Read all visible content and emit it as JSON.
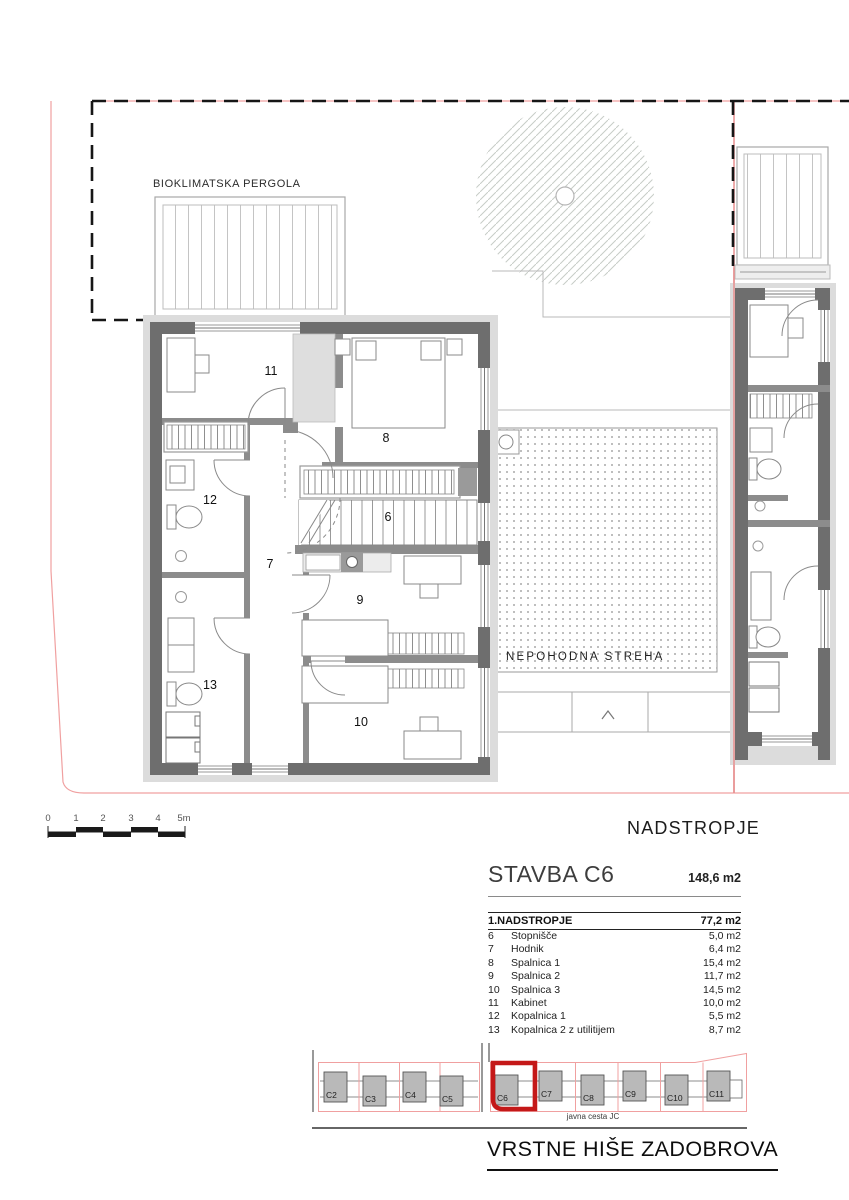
{
  "plan": {
    "pergola_label": "BIOKLIMATSKA PERGOLA",
    "roof_label": "NEPOHODNA STREHA",
    "floor_title": "NADSTROPJE"
  },
  "scale_bar": {
    "labels": [
      "0",
      "1",
      "2",
      "3",
      "4",
      "5m"
    ]
  },
  "legend": {
    "building": "STAVBA C6",
    "building_area": "148,6 m2",
    "floor": "1.NADSTROPJE",
    "floor_area": "77,2 m2",
    "rows": [
      {
        "num": "6",
        "name": "Stopnišče",
        "area": "5,0 m2"
      },
      {
        "num": "7",
        "name": "Hodnik",
        "area": "6,4 m2"
      },
      {
        "num": "8",
        "name": "Spalnica 1",
        "area": "15,4 m2"
      },
      {
        "num": "9",
        "name": "Spalnica 2",
        "area": "11,7 m2"
      },
      {
        "num": "10",
        "name": "Spalnica 3",
        "area": "14,5 m2"
      },
      {
        "num": "11",
        "name": "Kabinet",
        "area": "10,0 m2"
      },
      {
        "num": "12",
        "name": "Kopalnica 1",
        "area": "5,5 m2"
      },
      {
        "num": "13",
        "name": "Kopalnica 2 z utilitijem",
        "area": "8,7 m2"
      }
    ]
  },
  "site": {
    "units": [
      "C2",
      "C3",
      "C4",
      "C5",
      "C6",
      "C7",
      "C8",
      "C9",
      "C10",
      "C11"
    ],
    "highlighted_unit": "C6",
    "road_label": "javna cesta JC",
    "project_title": "VRSTNE HIŠE ZADOBROVA"
  },
  "colors": {
    "highlight_red": "#c41818",
    "parcel_red": "#f0a0a0",
    "wall_dark": "#6e6e6e",
    "wall_mid": "#8c8c8c",
    "sill_gray": "#dcdcdc"
  }
}
